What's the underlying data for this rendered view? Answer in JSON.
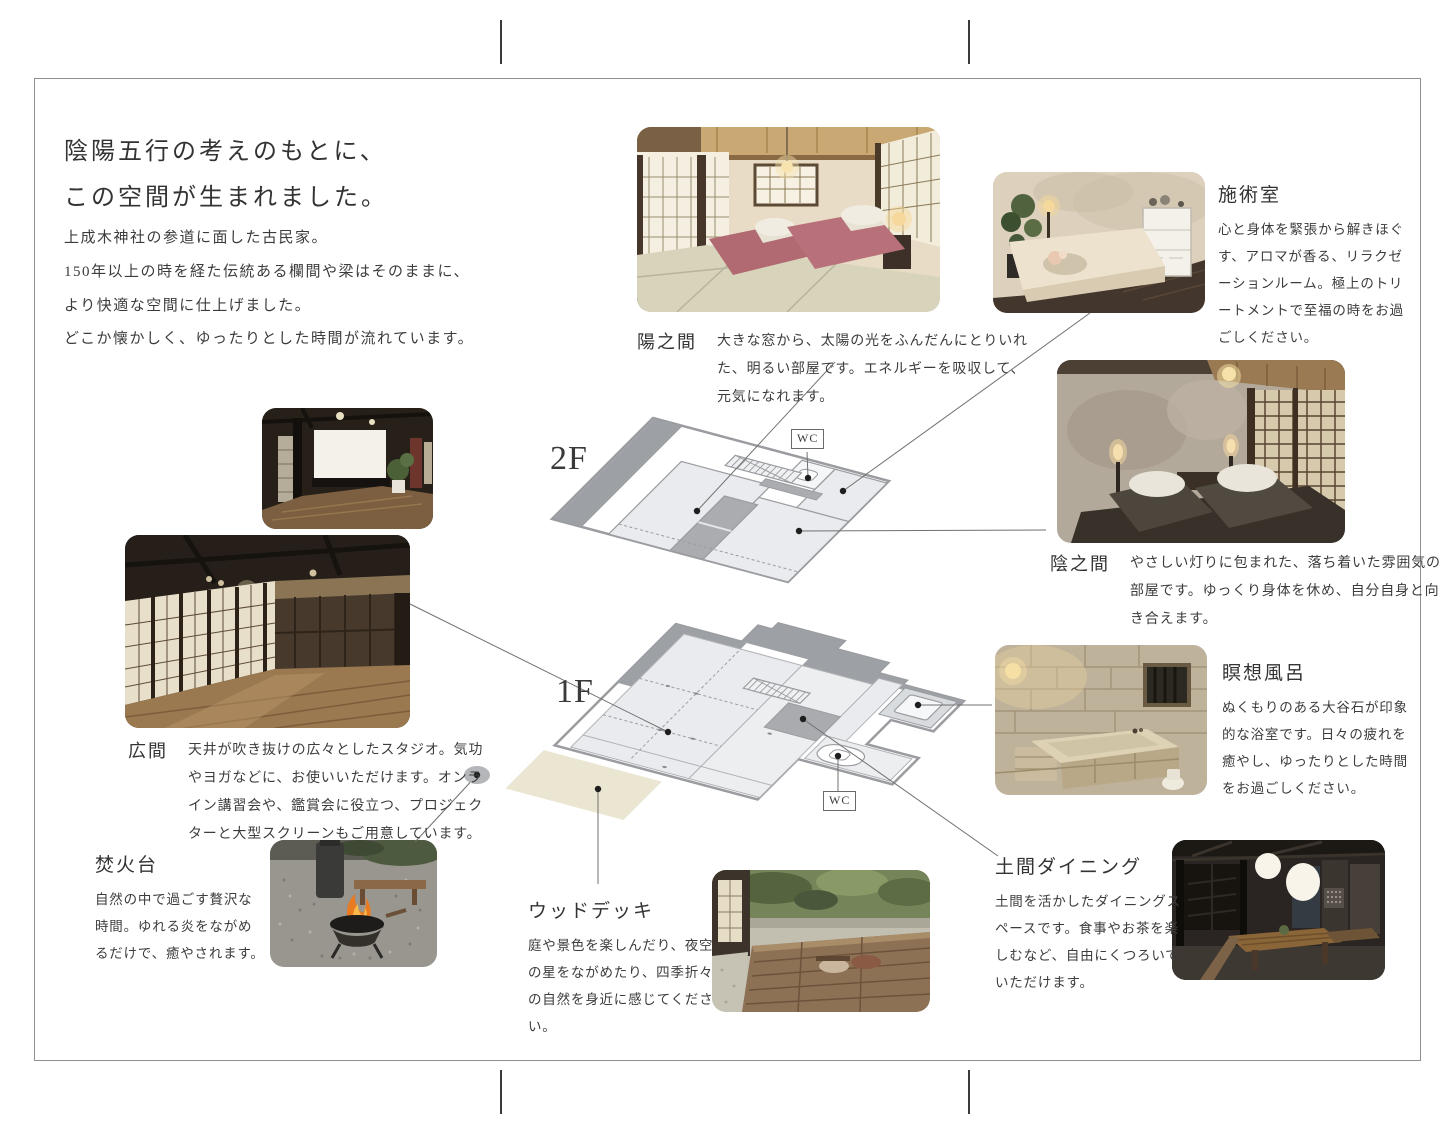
{
  "title": {
    "line1": "陰陽五行の考えのもとに、",
    "line2": "この空間が生まれました。"
  },
  "intro": {
    "line1": "上成木神社の参道に面した古民家。",
    "line2": "150年以上の時を経た伝統ある欄間や梁はそのままに、",
    "line3": "より快適な空間に仕上げました。",
    "line4": "どこか懐かしく、ゆったりとした時間が流れています。"
  },
  "floor_plan": {
    "floor2_label": "2F",
    "floor1_label": "1F",
    "wc_label": "WC"
  },
  "rooms": {
    "hi_no_ma": {
      "name": "陽之間",
      "description": "大きな窓から、太陽の光をふんだんにとりいれた、明るい部屋です。エネルギーを吸収して、元気になれます。"
    },
    "sejutsu": {
      "name": "施術室",
      "description": "心と身体を緊張から解きほぐす、アロマが香る、リラクゼーションルーム。極上のトリートメントで至福の時をお過ごしください。"
    },
    "kage_no_ma": {
      "name": "陰之間",
      "description": "やさしい灯りに包まれた、落ち着いた雰囲気の部屋です。ゆっくり身体を休め、自分自身と向き合えます。"
    },
    "meiso_buro": {
      "name": "瞑想風呂",
      "description": "ぬくもりのある大谷石が印象的な浴室です。日々の疲れを癒やし、ゆったりとした時間をお過ごしください。"
    },
    "hiroma": {
      "name": "広間",
      "description": "天井が吹き抜けの広々としたスタジオ。気功やヨガなどに、お使いいただけます。オンライン講習会や、鑑賞会に役立つ、プロジェクターと大型スクリーンもご用意しています。"
    },
    "takibidai": {
      "name": "焚火台",
      "description": "自然の中で過ごす贅沢な時間。ゆれる炎をながめるだけで、癒やされます。"
    },
    "wood_deck": {
      "name": "ウッドデッキ",
      "description": "庭や景色を楽しんだり、夜空の星をながめたり、四季折々の自然を身近に感じてください。"
    },
    "doma_dining": {
      "name": "土間ダイニング",
      "description": "土間を活かしたダイニングスペースです。食事やお茶を楽しむなど、自由にくつろいでいただけます。"
    }
  },
  "colors": {
    "wall_gray": "#9a9ca0",
    "room_fill": "#e9ebee",
    "dark_fill": "#9da0a4",
    "deck_fill": "#eae6d1",
    "line": "#707070"
  }
}
